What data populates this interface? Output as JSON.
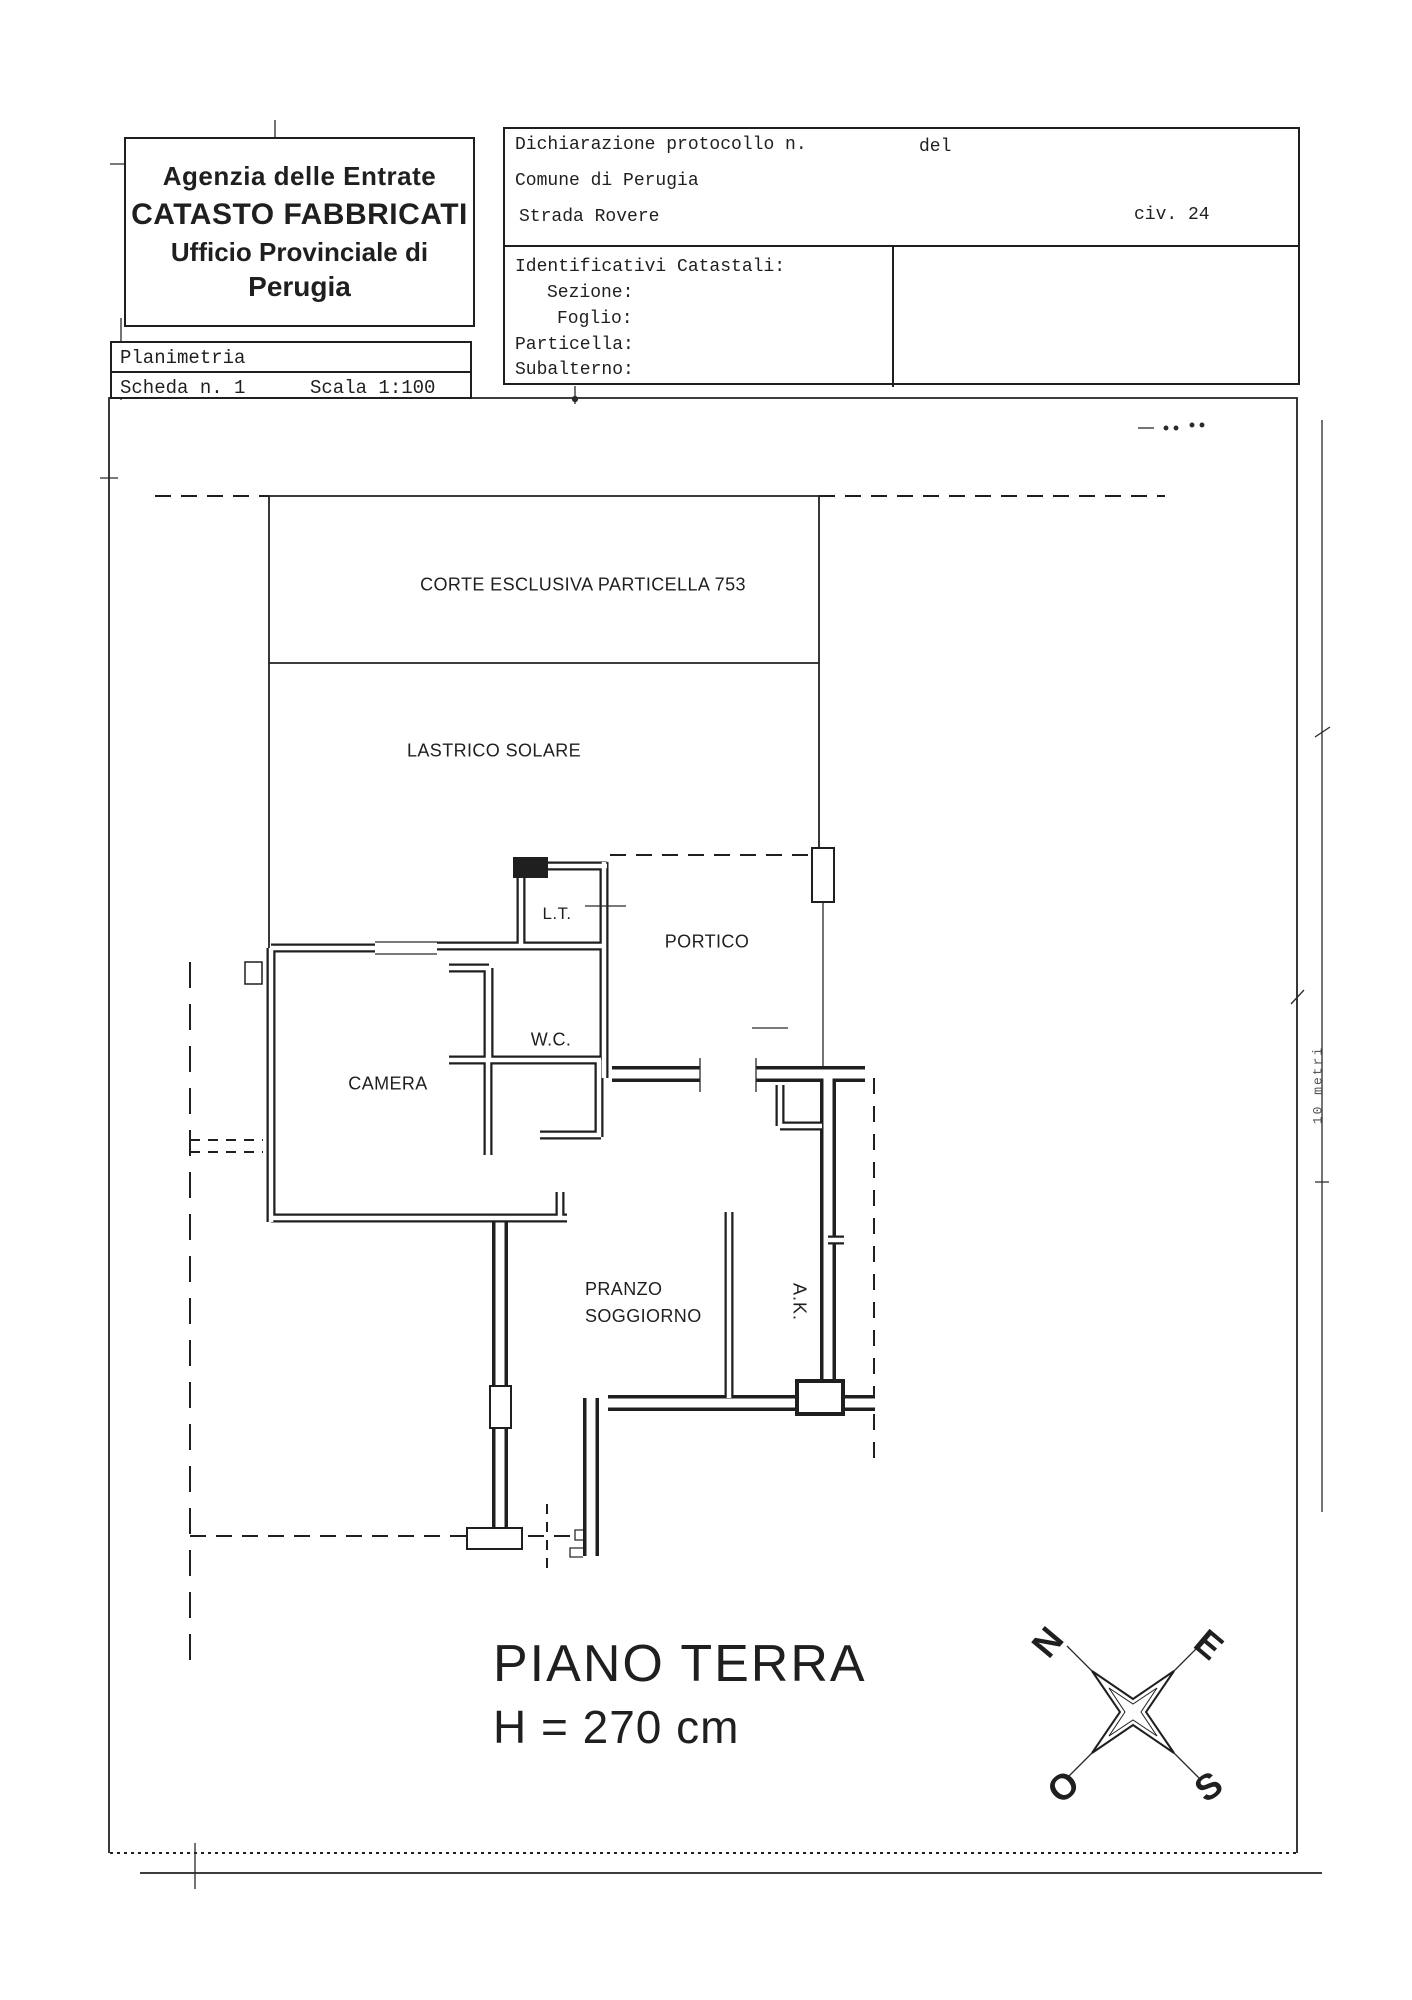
{
  "document": {
    "agency": {
      "line1": "Agenzia delle Entrate",
      "line2": "CATASTO FABBRICATI",
      "line3": "Ufficio Provinciale di",
      "line4": "Perugia"
    },
    "planimetria": {
      "title": "Planimetria",
      "scheda": "Scheda n. 1",
      "scala": "Scala 1:100"
    },
    "declaration": {
      "protocol": "Dichiarazione protocollo n.",
      "del": "del",
      "comune": "Comune di Perugia",
      "street": "Strada Rovere",
      "civic": "civ. 24"
    },
    "cadastral": {
      "title": "Identificativi Catastali:",
      "sezione": "Sezione:",
      "foglio": "Foglio:",
      "particella": "Particella:",
      "subalterno": "Subalterno:"
    }
  },
  "plan": {
    "labels": {
      "corte": "CORTE ESCLUSIVA PARTICELLA 753",
      "lastrico": "LASTRICO SOLARE",
      "lt": "L.T.",
      "portico": "PORTICO",
      "wc": "W.C.",
      "camera": "CAMERA",
      "pranzo1": "PRANZO",
      "pranzo2": "SOGGIORNO",
      "ak": "A.K."
    },
    "floor": {
      "title": "PIANO TERRA",
      "height": "H = 270 cm"
    },
    "scale_note": "10 metri",
    "compass": {
      "north": "N",
      "east": "E",
      "west": "O",
      "south": "S"
    }
  },
  "colors": {
    "ink": "#1f1f1f",
    "paper": "#ffffff"
  }
}
